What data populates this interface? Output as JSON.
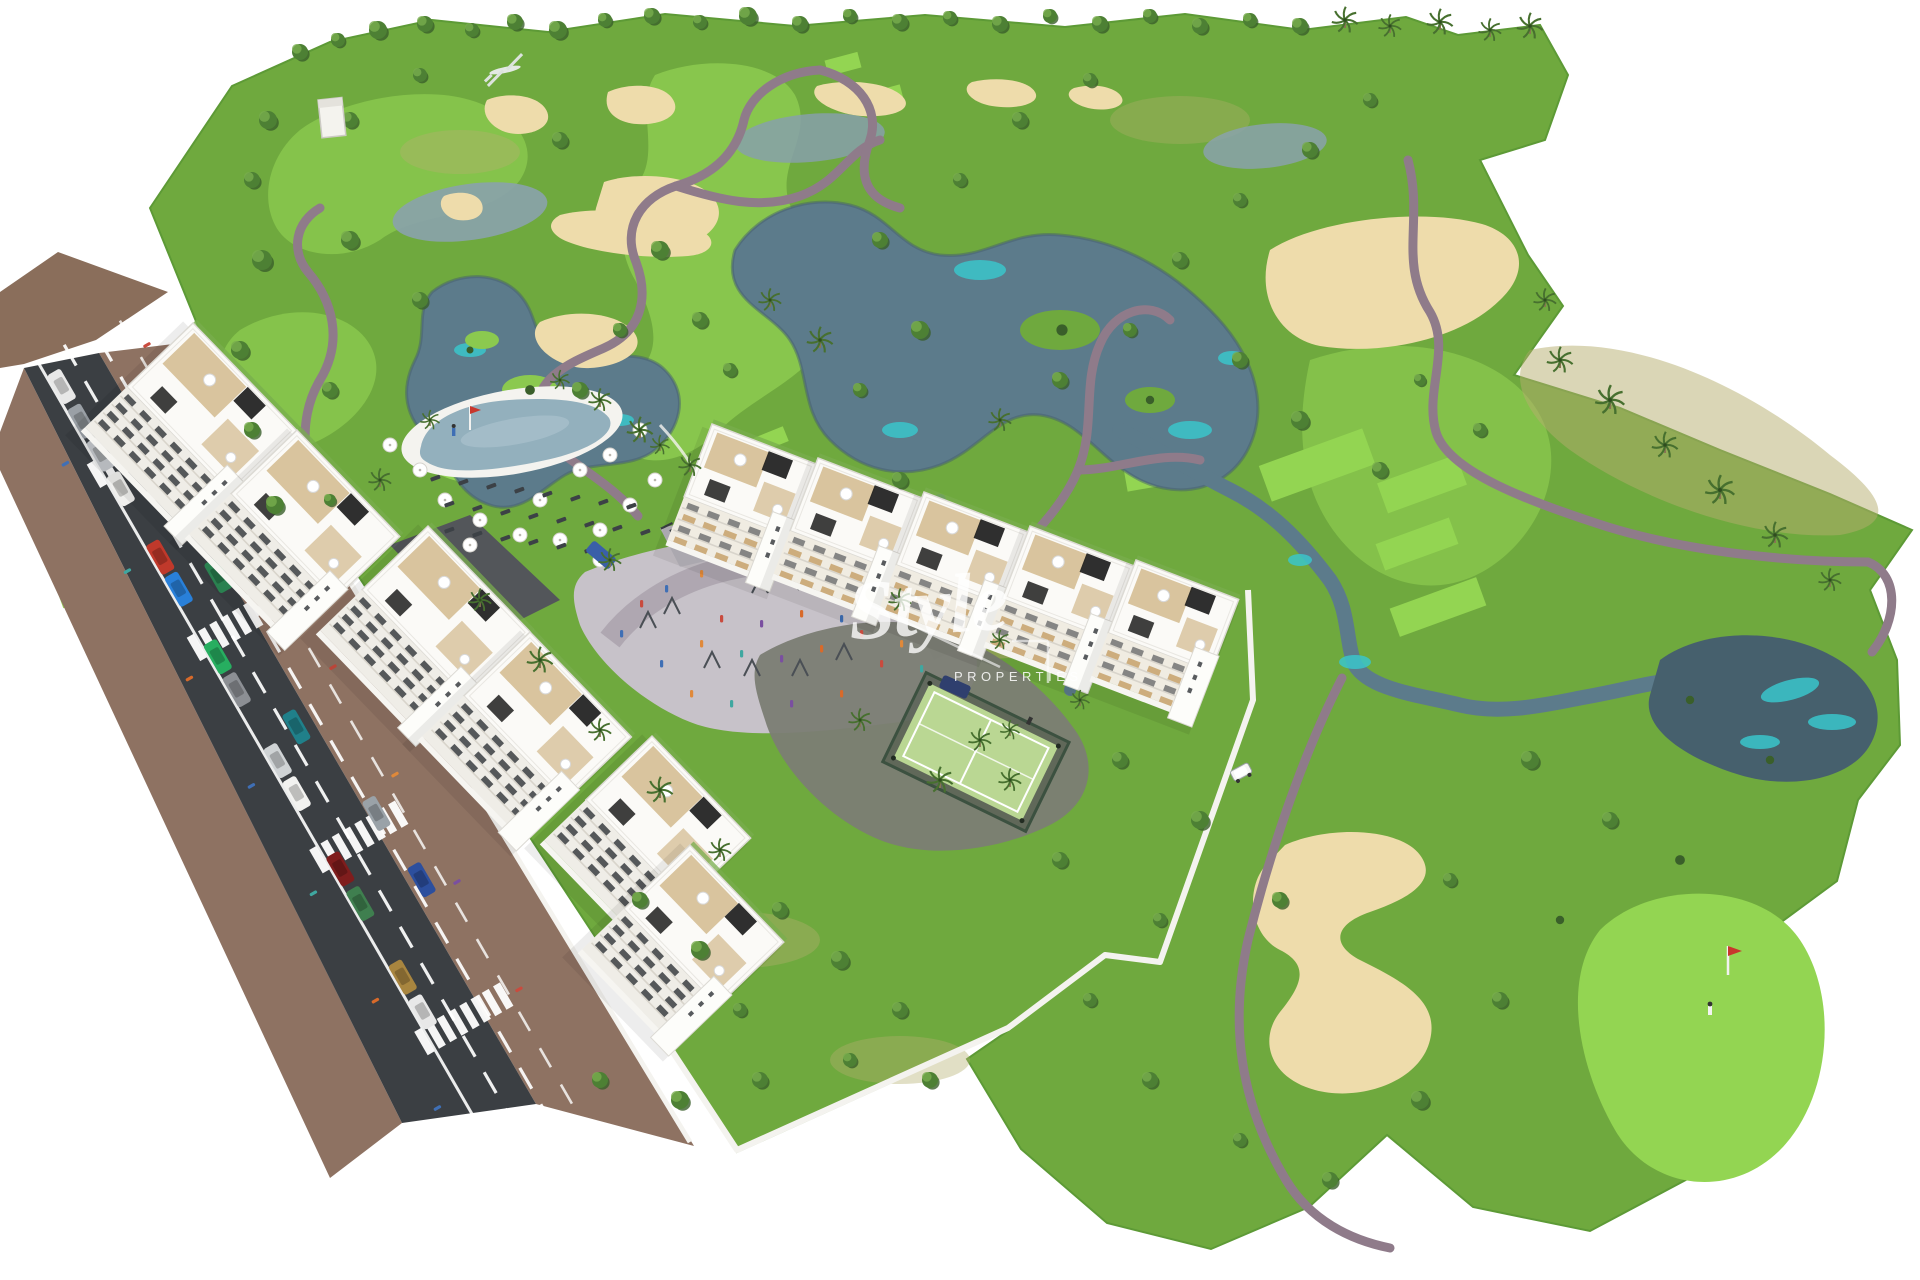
{
  "meta": {
    "type": "architectural-aerial-render",
    "description": "Aerial 3D render of a white new-build apartment complex with communal pool, playground plaza and padel court, set beside a golf course with winding cart paths, lakes, sand bunkers, palm trees and a putting green with flag; an asphalt access road with parked cars and crosswalks runs along the lower left.",
    "canvas": {
      "width": 1920,
      "height": 1280
    },
    "background": "#ffffff"
  },
  "watermark": {
    "script_text": "Style",
    "caps_text": "PROPERTIES",
    "color": "#ffffff"
  },
  "palette": {
    "bg": "#ffffff",
    "grass": "#6fa93e",
    "grass-light": "#8bc94f",
    "grass-dark": "#5d9a36",
    "tee": "#93d552",
    "dry": "#b5ae6e",
    "sand": "#eedcab",
    "sand-light": "#f5e9c8",
    "water": "#5c7b8b",
    "water-dark": "#46606d",
    "teal": "#3ac6cb",
    "pool": "#93b0bd",
    "path": "#8f7b8a",
    "walk": "#8e7262",
    "dirt": "#8a6e5b",
    "asphalt": "#3b3f43",
    "plaza": "#c7c2c9",
    "plaza-dark": "#7b7d74",
    "court": "#bad793",
    "fence": "#3c5140",
    "wall": "#f4f3ef",
    "bldg": "#fbfaf7",
    "bldg-shade": "#e8e6e1",
    "window": "#2e3237",
    "wood": "#c7a26b",
    "deck": "#d7c199",
    "pergola": "#1d1d1d",
    "tree": "#4d8034",
    "tree-dark": "#3a5f2a",
    "tree-light": "#78ad4e",
    "palm": "#47702f",
    "trunk": "#8a7354"
  },
  "scene": {
    "features": [
      {
        "id": "golf-course",
        "label": "Golf course with fairways, mounds and rough"
      },
      {
        "id": "lakes",
        "label": "Irregular slate-blue lakes with turquoise shallows"
      },
      {
        "id": "sand-bunkers",
        "label": "Sand bunkers and waste areas"
      },
      {
        "id": "cart-paths",
        "label": "Winding mauve golf cart paths"
      },
      {
        "id": "putting-green",
        "label": "Bright putting green with flagstick and golfer"
      },
      {
        "id": "apartment-row-west",
        "label": "Stepped white apartment row along the access road"
      },
      {
        "id": "apartment-row-east",
        "label": "White apartment row with wood balconies facing the course"
      },
      {
        "id": "swimming-pool",
        "label": "Lagoon pool with white parasols and sun loungers"
      },
      {
        "id": "playground-plaza",
        "label": "Paved playground / outdoor gym plaza with people"
      },
      {
        "id": "padel-court",
        "label": "Fenced green padel court"
      },
      {
        "id": "access-road",
        "label": "Asphalt road with lane markings, crosswalks and parked cars"
      },
      {
        "id": "garden-walls",
        "label": "White perimeter garden walls"
      },
      {
        "id": "golf-cart",
        "label": "White golf cart on path"
      },
      {
        "id": "palm-trees",
        "label": "Palms and round canopy trees"
      }
    ]
  }
}
